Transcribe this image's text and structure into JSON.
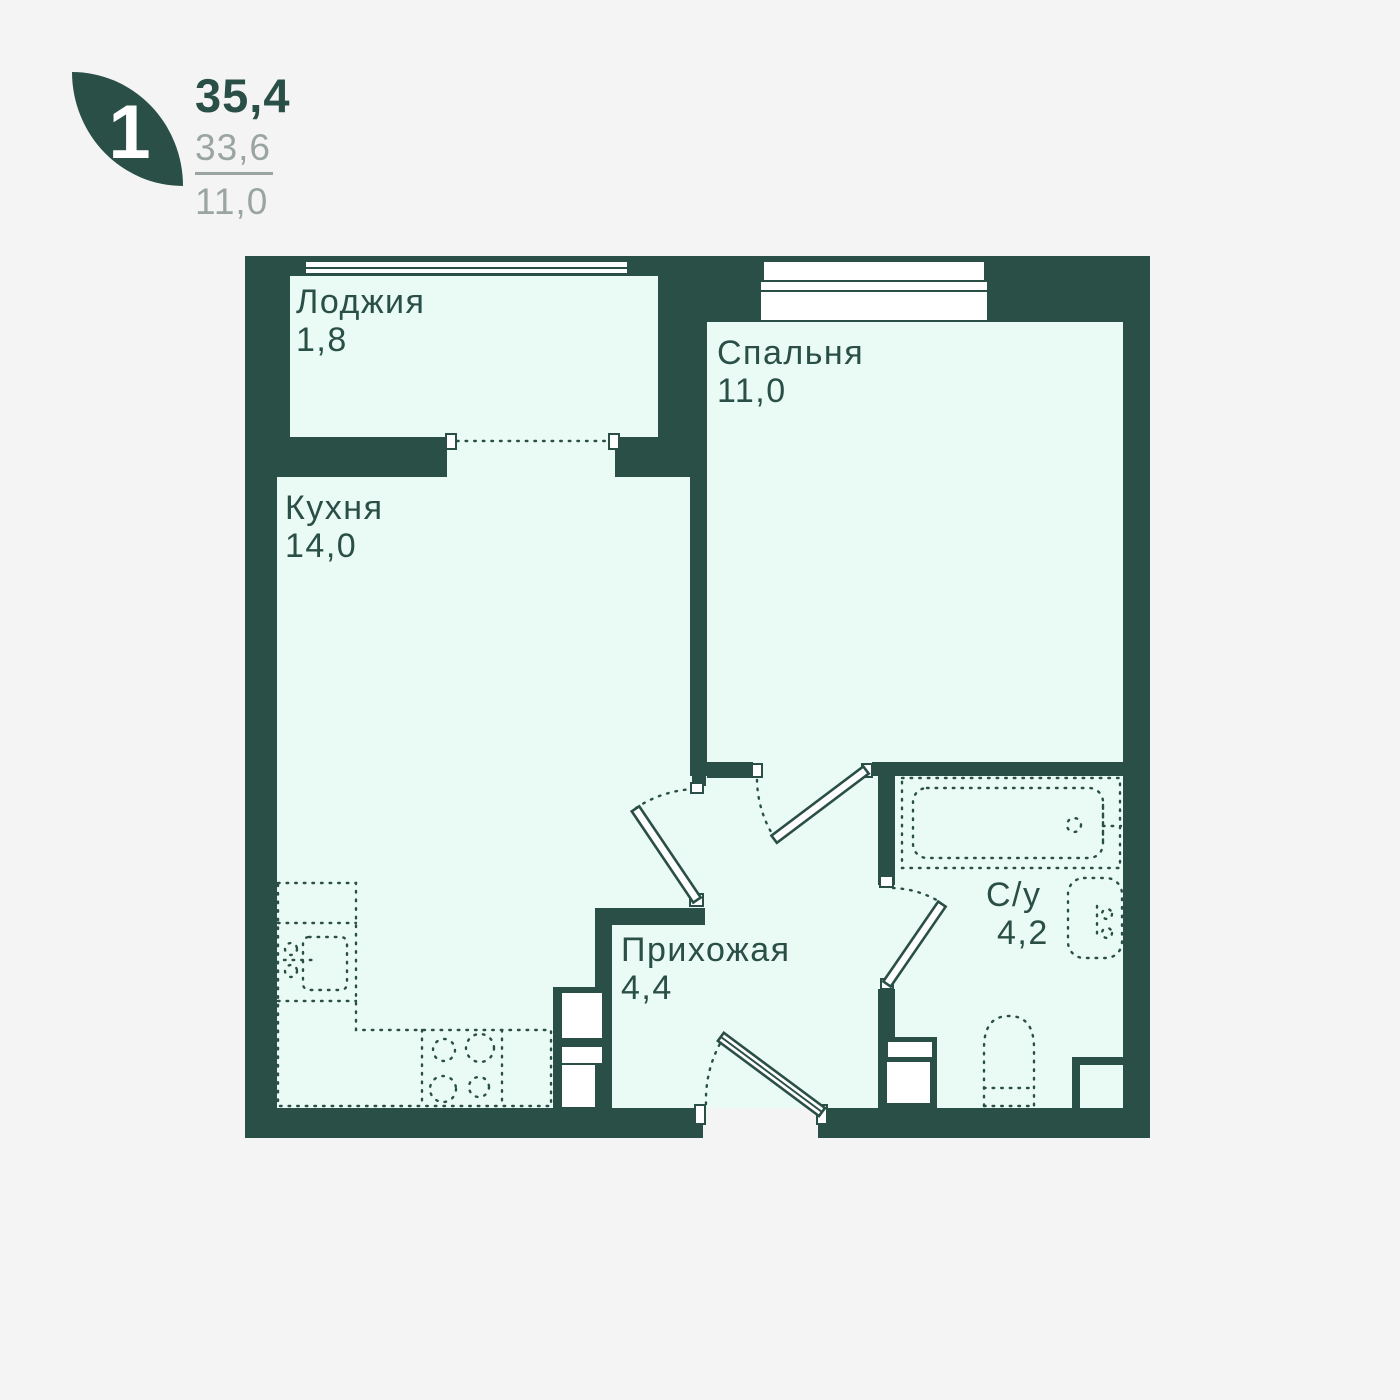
{
  "unit": {
    "rooms_count": "1",
    "total_area": "35,4",
    "living_area": "33,6",
    "kitchen_area": "11,0"
  },
  "rooms": [
    {
      "name": "Лоджия",
      "area": "1,8"
    },
    {
      "name": "Спальня",
      "area": "11,0"
    },
    {
      "name": "Кухня",
      "area": "14,0"
    },
    {
      "name": "Прихожая",
      "area": "4,4"
    },
    {
      "name": "С/у",
      "area": "4,2"
    }
  ],
  "colors": {
    "wall": "#2a4f47",
    "room_fill": "#eafaf4",
    "background": "#f5f4f4",
    "muted_text": "#9aa5a1",
    "badge_text": "#ffffff"
  }
}
